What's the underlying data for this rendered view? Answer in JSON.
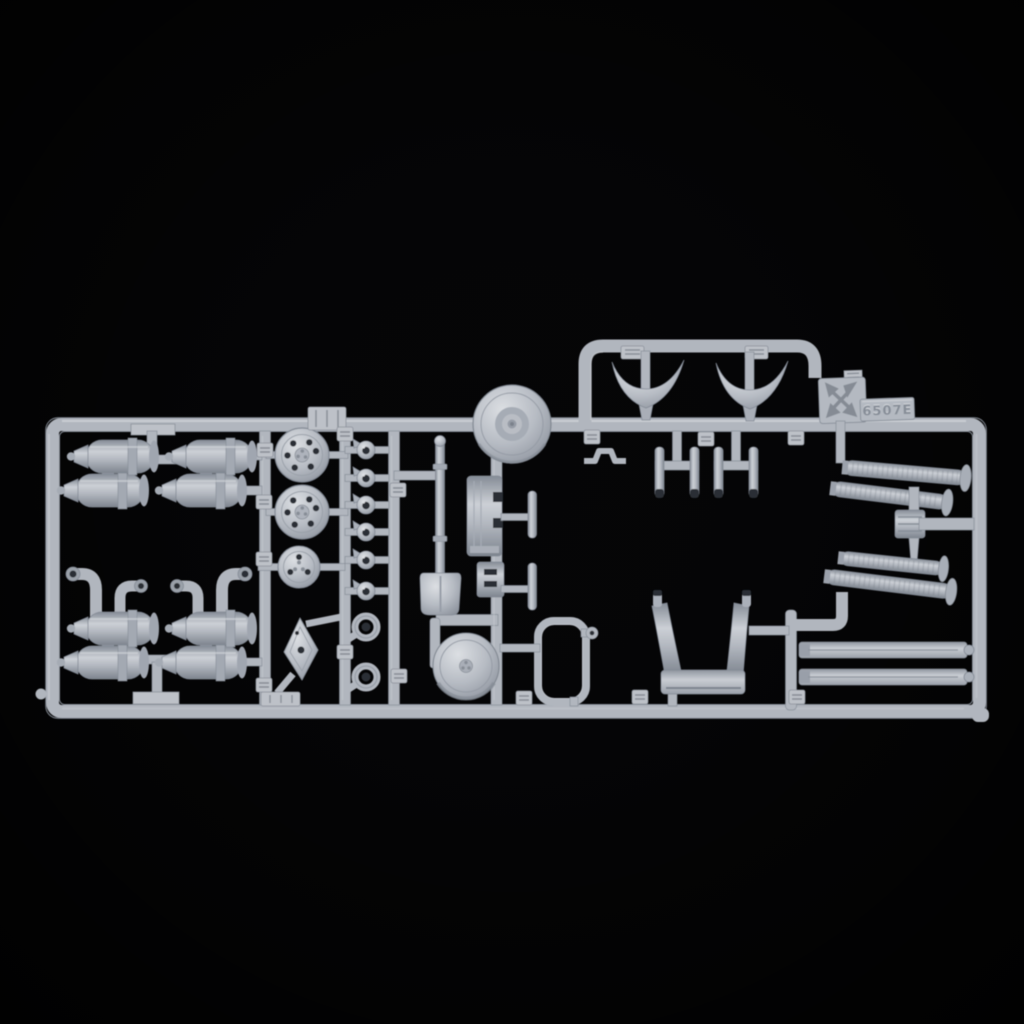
{
  "photo": {
    "subject": "Light grey injection-moulded model kit sprue (parts tree) photographed on a black background",
    "background_color": "#050506",
    "sprue": {
      "base_color": "#b1b6be",
      "highlight_color": "#d6d9de",
      "shadow_color": "#7f8690",
      "dark_tip_color": "#2c2f34",
      "tag": {
        "number_text": "6507E",
        "logo": "molded-arrows-star-logo"
      },
      "parts": [
        "outer rectangular frame with vertical runners",
        "twin-canister assembly (top left, x2)",
        "twin-canister assembly with curved intake pipes (bottom left, x2)",
        "large round hub cap with bolt holes (x2)",
        "small round hub cap",
        "diamond-shaped backing plate",
        "small valve / grease-nipple fitting (x6)",
        "towing eye ring (x2)",
        "shovel",
        "stowage box lid panel",
        "latch block fitting",
        "grab handle (x2)",
        "dished road wheel",
        "small drum wheel",
        "rounded hatch frame",
        "curved deflector blade (x2)",
        "twin-post bracket (x2)",
        "U-shaped mounting cradle",
        "ribbed flexible exhaust pipe (x4)",
        "ribbed coupling block",
        "long side rail (x2)",
        "small clamp bracket",
        "molded part-number tabs",
        "manufacturer logo tab with kit number"
      ]
    }
  }
}
